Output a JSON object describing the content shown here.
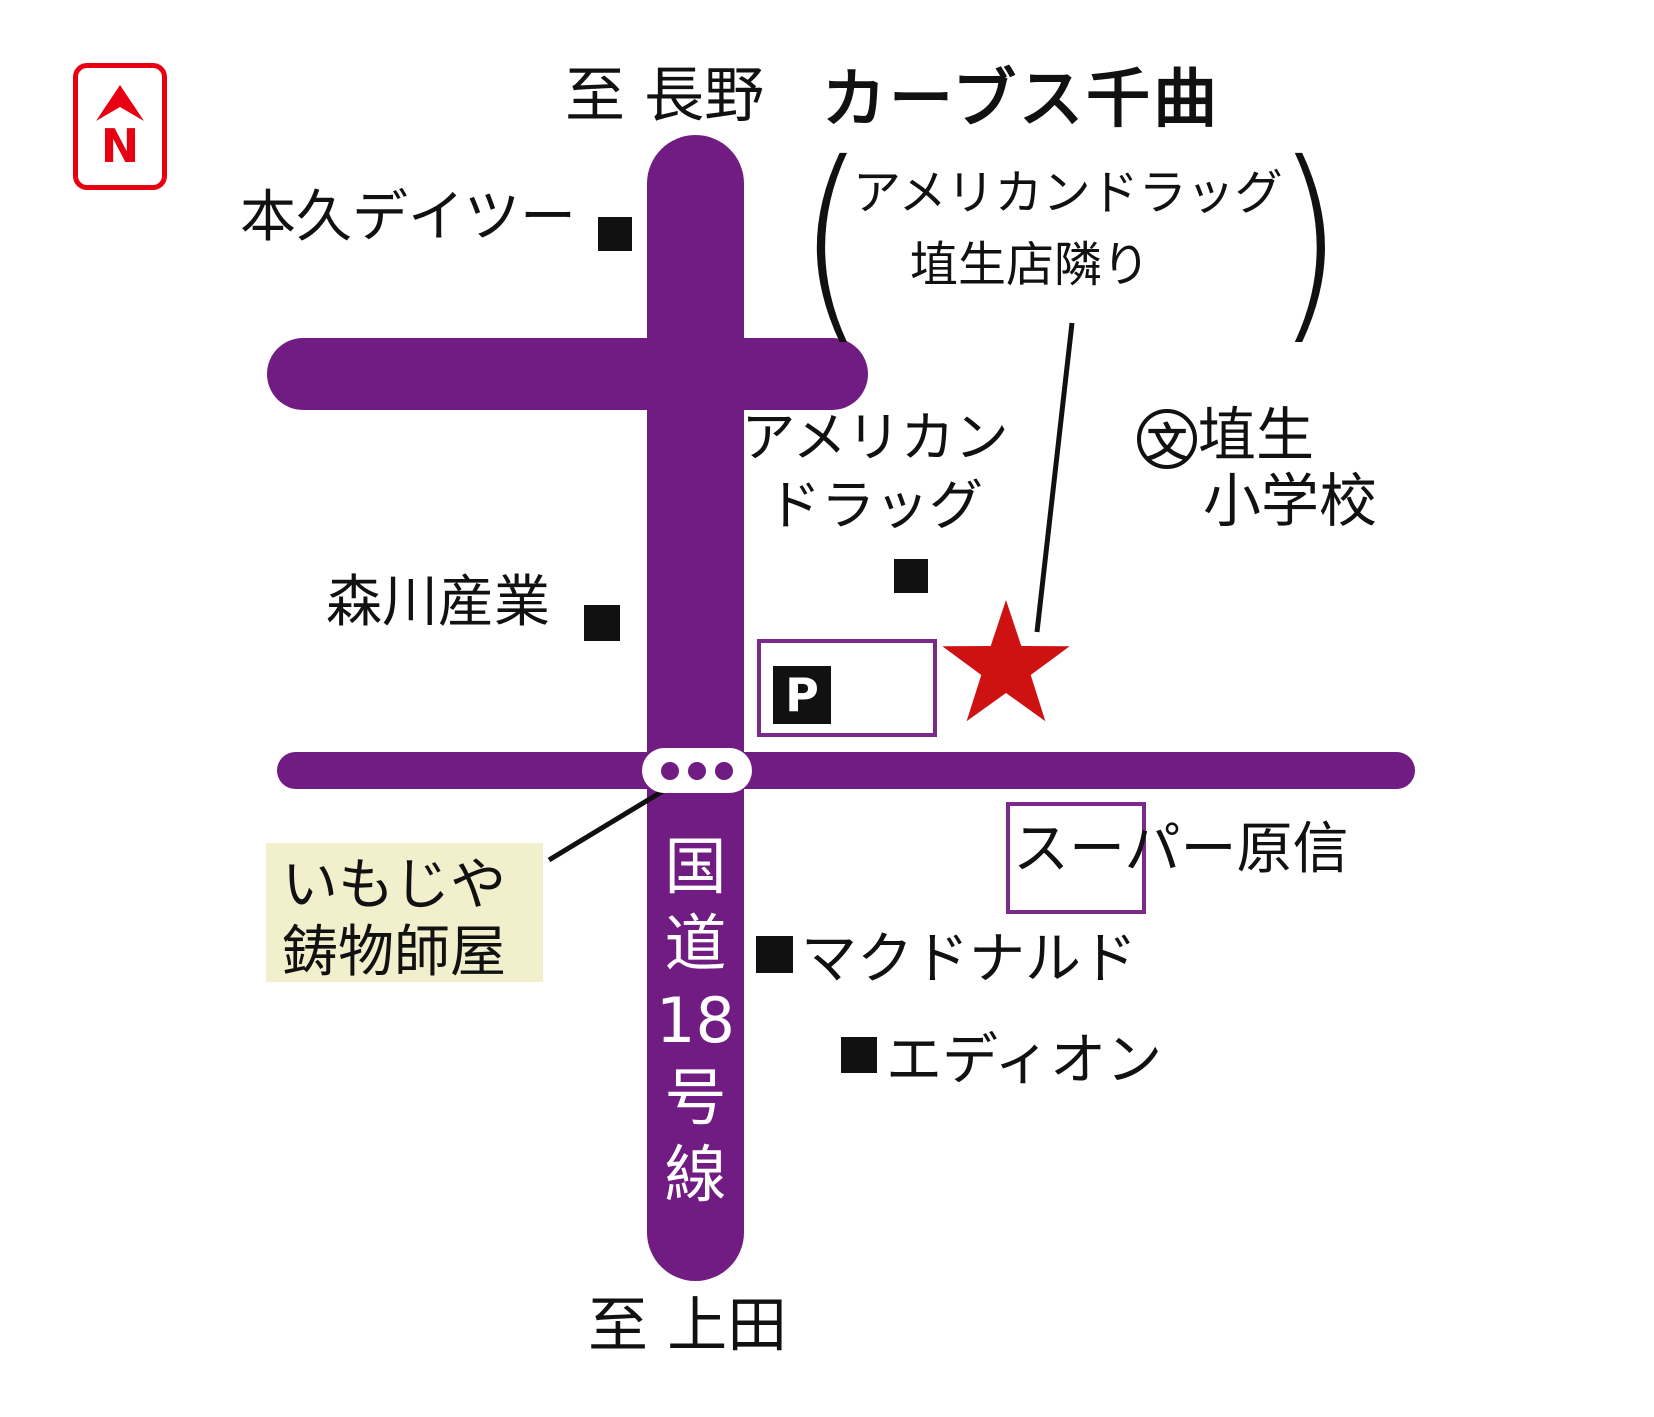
{
  "header": {
    "title": "カーブス千曲",
    "paren_open": "(",
    "paren_close": ")",
    "subtitle_line1": "アメリカンドラッグ",
    "subtitle_line2": "埴生店隣り"
  },
  "compass": {
    "letter": "N"
  },
  "directions": {
    "north": "至 長野",
    "south": "至 上田"
  },
  "route": {
    "chars": [
      "国",
      "道",
      "18",
      "号",
      "線"
    ]
  },
  "landmarks": {
    "honkyu": "本久デイツー",
    "morikawa": "森川産業",
    "american_drug_line1": "アメリカン",
    "american_drug_line2": "ドラッグ",
    "school_symbol": "文",
    "school_line1": "埴生",
    "school_line2": "小学校",
    "parking": "P",
    "harashin": "スーパー原信",
    "mcdonalds": "マクドナルド",
    "edion": "エディオン",
    "imojiya_line1": "いもじや",
    "imojiya_line2": "鋳物師屋"
  },
  "colors": {
    "road_purple": "#701c82",
    "box_border_purple": "#7b2a8c",
    "star_red": "#ce1212",
    "north_red": "#e60012",
    "highlight_yellow": "#f2efcd"
  }
}
